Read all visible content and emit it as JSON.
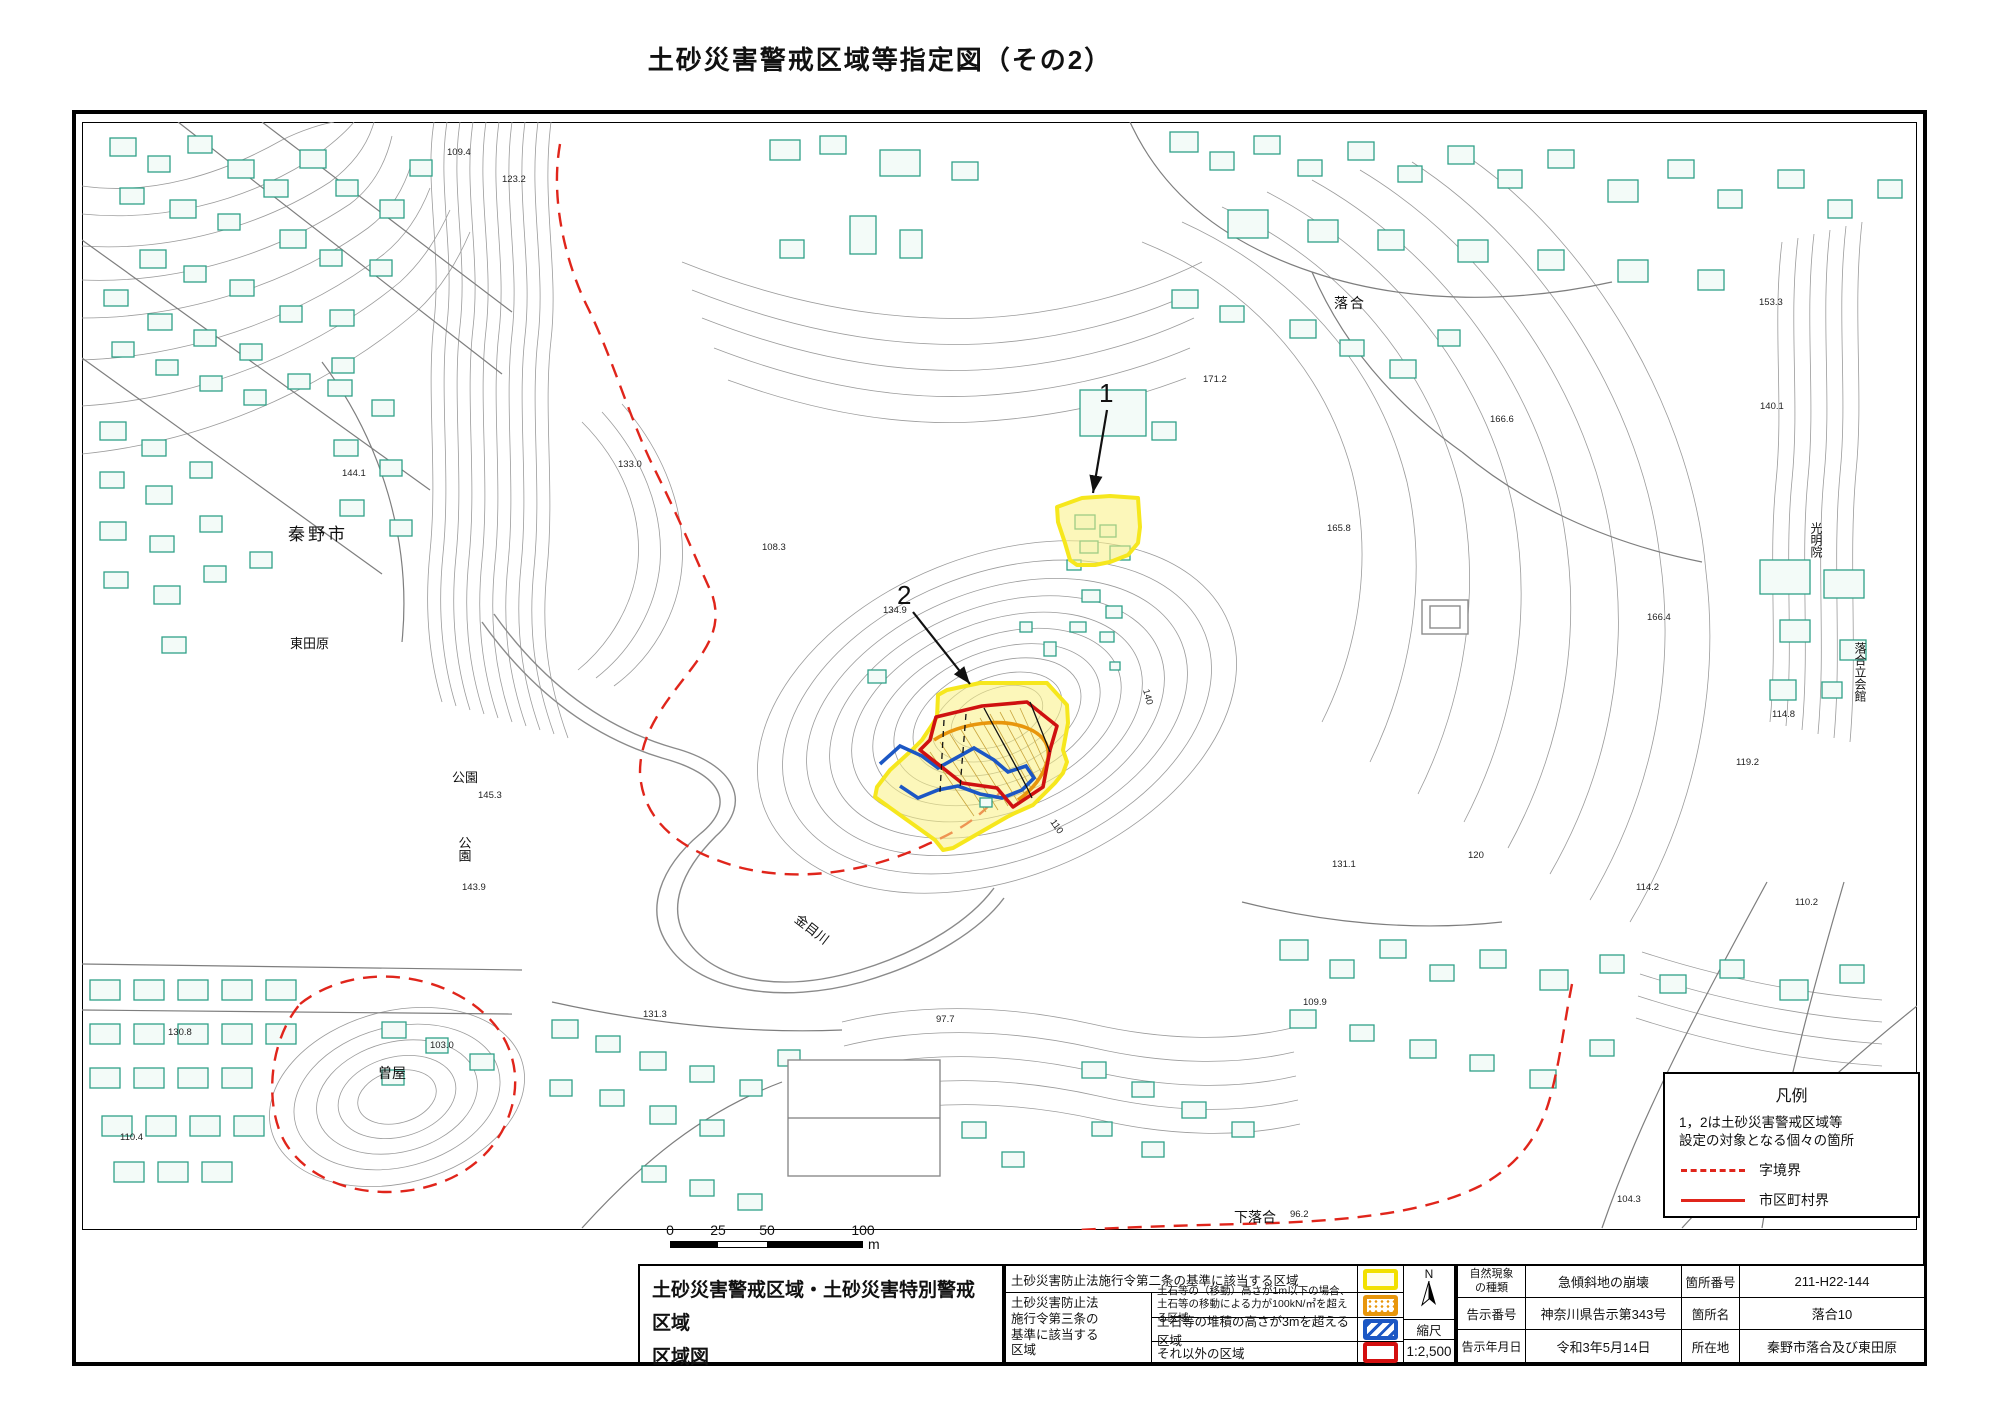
{
  "title": "土砂災害警戒区域等指定図（その2）",
  "map": {
    "place_labels": [
      {
        "text": "秦野市"
      },
      {
        "text": "東田原"
      },
      {
        "text": "公園"
      },
      {
        "text": "公園"
      },
      {
        "text": "曽屋"
      },
      {
        "text": "金目川"
      },
      {
        "text": "下落合"
      },
      {
        "text": "落合"
      },
      {
        "text": "光明院"
      },
      {
        "text": "落合立会館"
      }
    ],
    "zone_markers": {
      "zone1": "1",
      "zone2": "2"
    },
    "elevations": [
      "109.4",
      "144.1",
      "133.0",
      "108.3",
      "134.9",
      "171.2",
      "166.6",
      "165.8",
      "140.1",
      "153.3",
      "166.4",
      "114.8",
      "119.2",
      "131.1",
      "120",
      "97.7",
      "131.3",
      "103.0",
      "143.9",
      "145.3",
      "110.4",
      "130.8",
      "110.2",
      "104.3",
      "96.2",
      "114.2",
      "109.9",
      "140",
      "110",
      "123.2"
    ]
  },
  "legend_box": {
    "title": "凡例",
    "note": "1，2は土砂災害警戒区域等\n設定の対象となる個々の箇所",
    "dashed_label": "字境界",
    "solid_label": "市区町村界"
  },
  "scale_bar": {
    "t0": "0",
    "t25": "25",
    "t50": "50",
    "t100": "100",
    "unit": "m"
  },
  "bottom_table": {
    "map_title": "土砂災害警戒区域・土砂災害特別警戒区域\n区域図",
    "legend": {
      "row1": "土砂災害防止法施行令第二条の基準に該当する区域",
      "group_label": "土砂災害防止法\n施行令第三条の\n基準に該当する\n区域",
      "row2": "土石等の（移動）高さが1m以下の場合、\n土石等の移動による力が100kN/㎡を超える区域",
      "row3": "土石等の堆積の高さが3mを超える区域",
      "row4": "それ以外の区域"
    },
    "compass": {
      "north": "N",
      "scale_label": "縮尺",
      "scale_value": "1:2,500"
    },
    "info": {
      "nature_label": "自然現象\nの種類",
      "nature_value": "急傾斜地の崩壊",
      "site_no_label": "箇所番号",
      "site_no_value": "211-H22-144",
      "notice_no_label": "告示番号",
      "notice_no_value": "神奈川県告示第343号",
      "site_name_label": "箇所名",
      "site_name_value": "落合10",
      "notice_date_label": "告示年月日",
      "notice_date_value": "令和3年5月14日",
      "location_label": "所在地",
      "location_value": "秦野市落合及び東田原"
    }
  },
  "colors": {
    "warning_yellow": "#f6e71d",
    "special_red": "#d40f0f",
    "orange_zone": "#e8960c",
    "blue_zone": "#1c57c4",
    "boundary_red": "#e0251b",
    "building_teal": "#2fa188",
    "contour_gray": "#9b9b9b"
  }
}
